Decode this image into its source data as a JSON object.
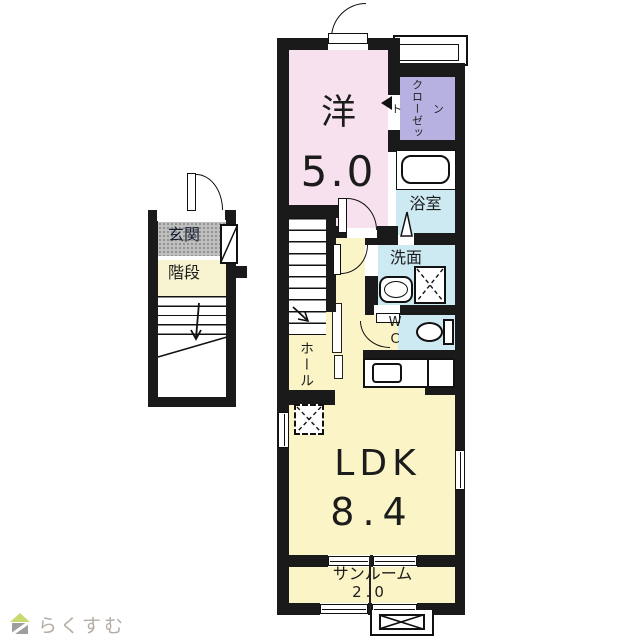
{
  "plan": {
    "type": "japanese-apartment-floor-plan-2F",
    "rooms": {
      "western_name": "洋",
      "western_size": "5.0",
      "wic": "ウォークイン\nクローゼット",
      "bath": "浴室",
      "washroom": "洗面",
      "wc": "W\nC",
      "hall": "ホール",
      "ldk_name": "LDK",
      "ldk_size": "8.4",
      "sunroom_name": "サンルーム",
      "sunroom_size": "2.0",
      "entrance": "玄関",
      "stairs": "階段"
    },
    "colors": {
      "wall": "#1a1a1a",
      "western_room": "#f8e1ee",
      "walkin_closet": "#b7b1e1",
      "wet_area_blue": "#cdeaf2",
      "living_yellow": "#faf4c6",
      "stairs_band": "#f7f3d0",
      "entrance_gray": "#bfbfbf"
    }
  },
  "logo": {
    "text": "らくすむ",
    "colors": {
      "roof": "#c9d970",
      "body": "#9e9e9e",
      "text": "#b5ada6"
    }
  }
}
